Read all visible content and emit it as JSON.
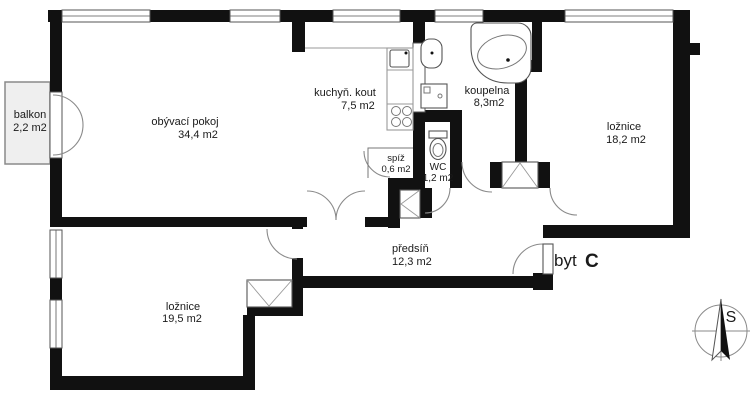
{
  "title": "Floor plan byt C",
  "apartment": {
    "label_prefix": "byt",
    "unit": "C"
  },
  "compass": {
    "north_label": "S"
  },
  "rooms": [
    {
      "id": "balkon",
      "name": "balkon",
      "area": "2,2 m2"
    },
    {
      "id": "obyvaci-pokoj",
      "name": "obývací pokoj",
      "area": "34,4 m2"
    },
    {
      "id": "kuchyn-kout",
      "name": "kuchyň. kout",
      "area": "7,5 m2"
    },
    {
      "id": "koupelna",
      "name": "koupelna",
      "area": "8,3m2"
    },
    {
      "id": "loznice-east",
      "name": "ložnice",
      "area": "18,2 m2"
    },
    {
      "id": "spiz",
      "name": "spíž",
      "area": "0,6 m2"
    },
    {
      "id": "wc",
      "name": "WC",
      "area": "1,2 m2"
    },
    {
      "id": "predsin",
      "name": "předsíň",
      "area": "12,3 m2"
    },
    {
      "id": "loznice-south",
      "name": "ložnice",
      "area": "19,5 m2"
    }
  ],
  "colors": {
    "wall": "#111111",
    "door_arc": "#8a8a8a",
    "window_line": "#555555",
    "balcony_fill": "#efefef",
    "text": "#1a1a1a"
  }
}
